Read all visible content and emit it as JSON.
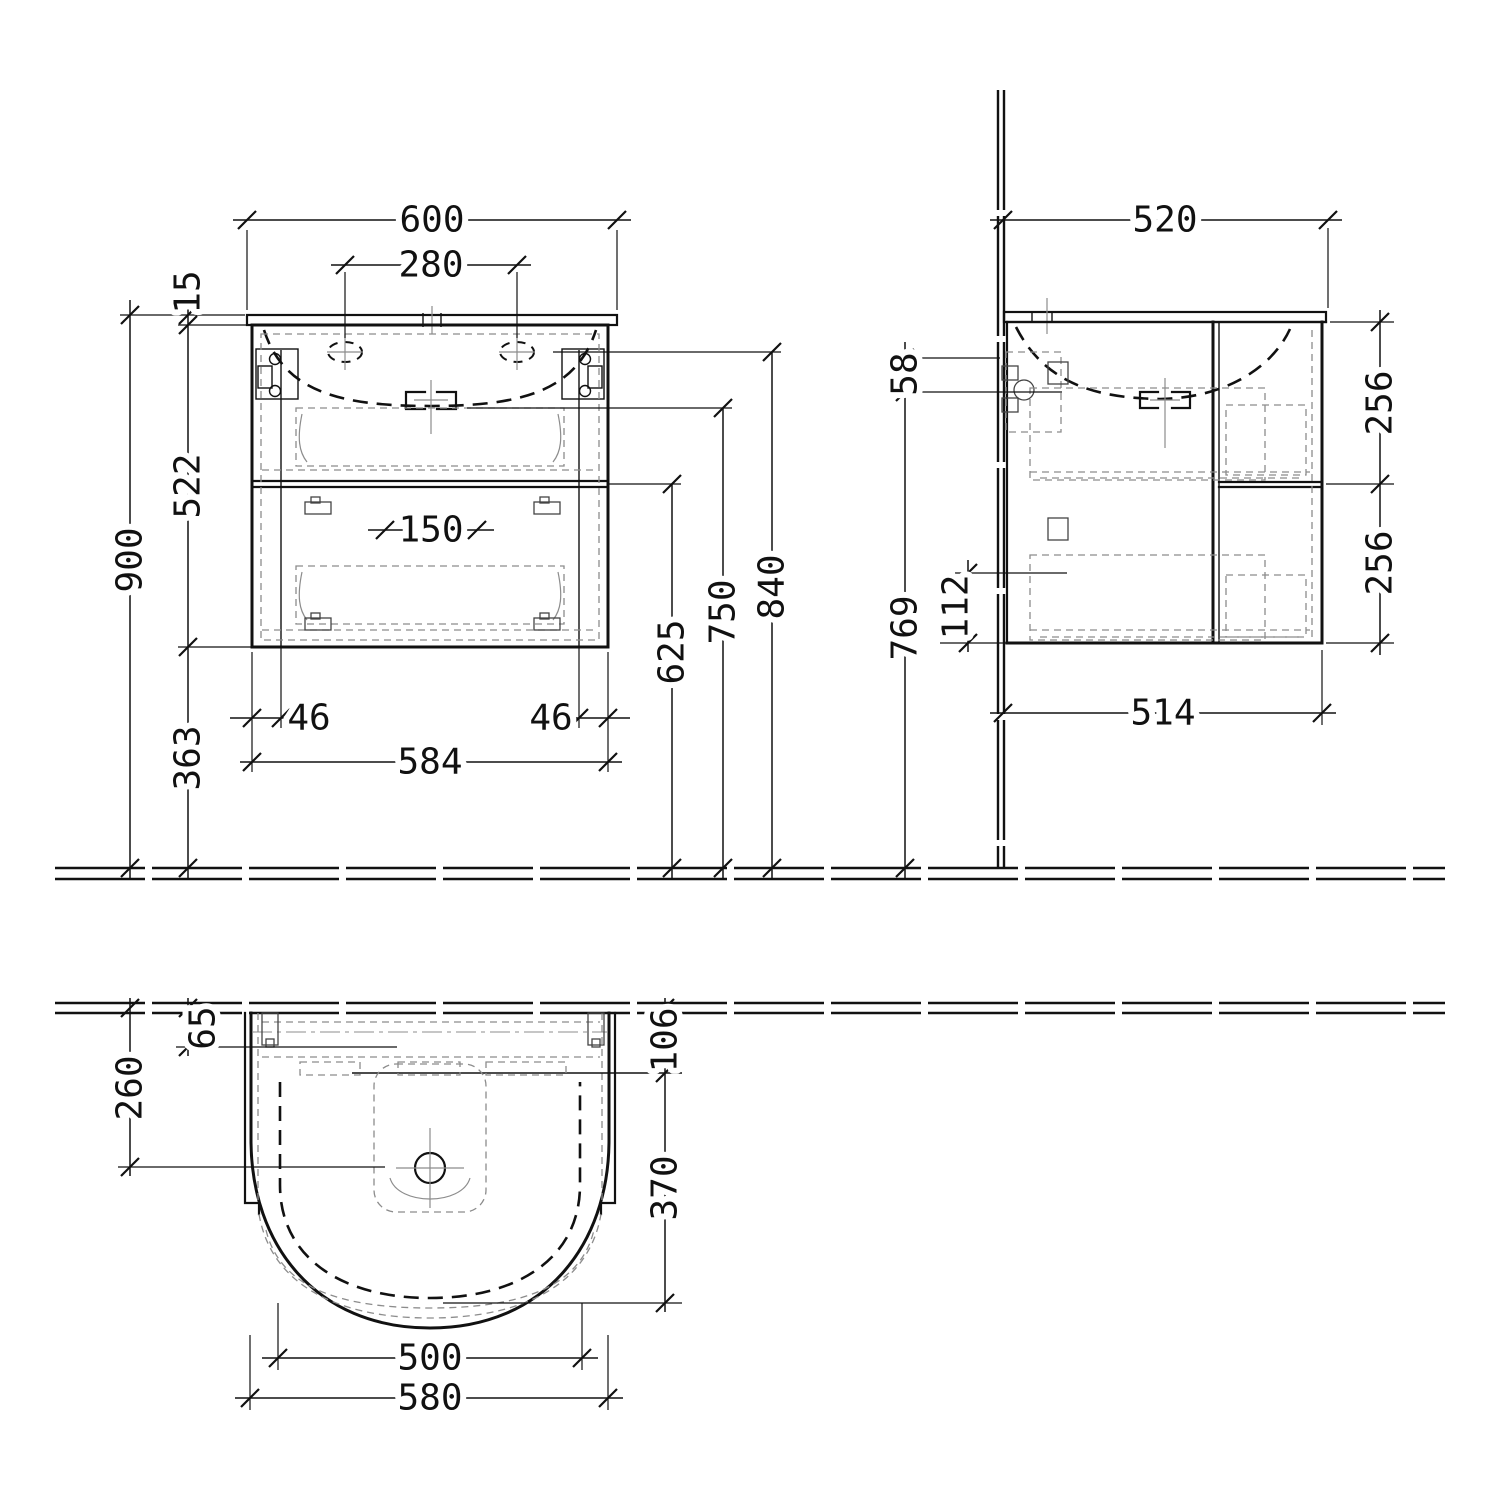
{
  "drawing": {
    "type": "technical-dimension-drawing",
    "subject": "wall-mounted bathroom vanity unit with washbasin, front / side / plan views",
    "unit": "mm",
    "line_color": "#111111",
    "detail_color": "#8c8c8c",
    "background": "#ffffff"
  },
  "dims": {
    "front": {
      "overall_width": "600",
      "tap_hole_spacing": "280",
      "countertop_thickness": "15",
      "cabinet_height": "522",
      "total_height": "900",
      "floor_clearance": "363",
      "fixing_offset_left": "46",
      "fixing_offset_right": "46",
      "fixing_width": "584",
      "siphon_cutout_width": "150",
      "drawer_divider_height": "625",
      "drain_height": "750",
      "basin_rim_height": "840"
    },
    "side": {
      "overall_depth": "520",
      "supply_drop": "58",
      "upper_drawer_front": "256",
      "lower_drawer_front": "256",
      "siphon_height": "112",
      "supply_height": "769",
      "cabinet_depth": "514"
    },
    "plan": {
      "tap_axis_offset": "65",
      "drain_axis_offset": "260",
      "basin_back_offset": "106",
      "basin_depth": "370",
      "basin_inner_width": "500",
      "basin_width": "580"
    }
  }
}
